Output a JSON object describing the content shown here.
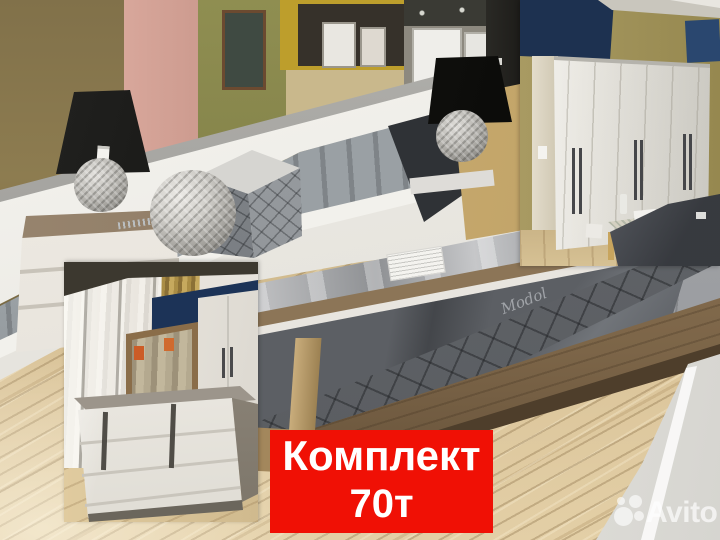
{
  "photo": {
    "type": "furniture showroom bedroom-set photo collage",
    "embroidery_text": "Modol"
  },
  "banner": {
    "line1": "Комплект",
    "line2": "70т",
    "background_color": "#f01005",
    "text_color": "#ffffff"
  },
  "watermark": {
    "text": "Avito",
    "color": "#ffffff"
  },
  "palette": {
    "floor_oak": "#dcc69c",
    "wall_olive": "#8d7c50",
    "wall_pink": "#d4a094",
    "wall_green": "#8f8e51",
    "wall_mustard": "#bd9e2c",
    "navy_wall": "#1d3150",
    "khaki_wall": "#a29356",
    "headboard_grey": "#999ea2",
    "bedspread_grey": "#5c5f64",
    "bench_grey": "#9b9da0",
    "bed_frame_wood": "#7c6548",
    "wardrobe_white": "#eceae3"
  }
}
